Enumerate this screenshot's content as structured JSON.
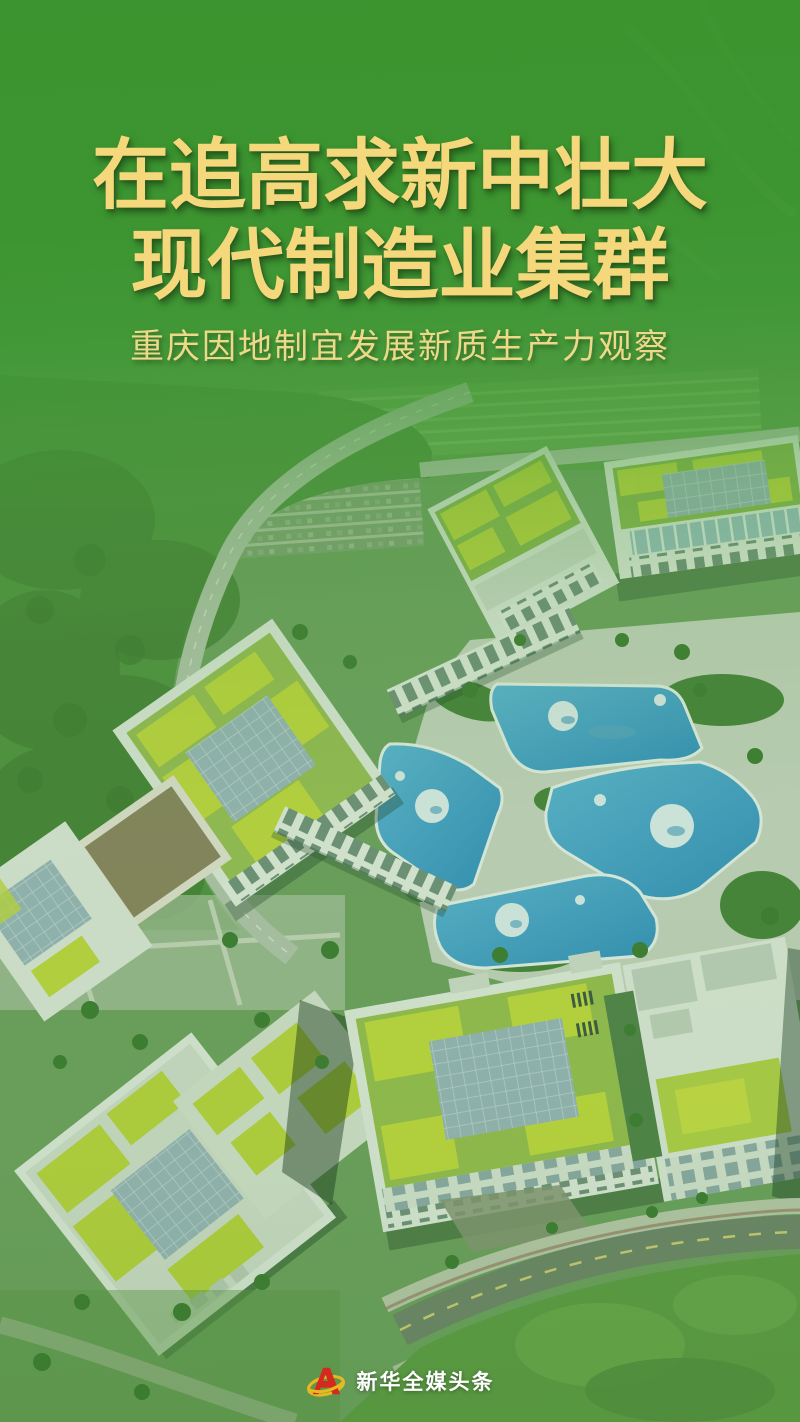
{
  "title": {
    "line1": "在追高求新中壮大",
    "line2": "现代制造业集群"
  },
  "subtitle": "重庆因地制宜发展新质生产力观察",
  "footer": {
    "brand": "新华全媒头条"
  },
  "scene": {
    "background": "aerial-photo-green-manufacturing-campus",
    "features": [
      "green-roof-buildings",
      "blue-planet-painted-plaza",
      "curved-roads",
      "lawns-and-trees"
    ]
  },
  "colors": {
    "title_gold": "#f5d77c",
    "subtitle_gold": "#eed989",
    "brand_text": "#ffffff",
    "logo_red": "#d42a1d",
    "logo_gold": "#e8b91f",
    "overlay_green": "#3a9430",
    "plaza_blue": "#3f9fd4"
  }
}
